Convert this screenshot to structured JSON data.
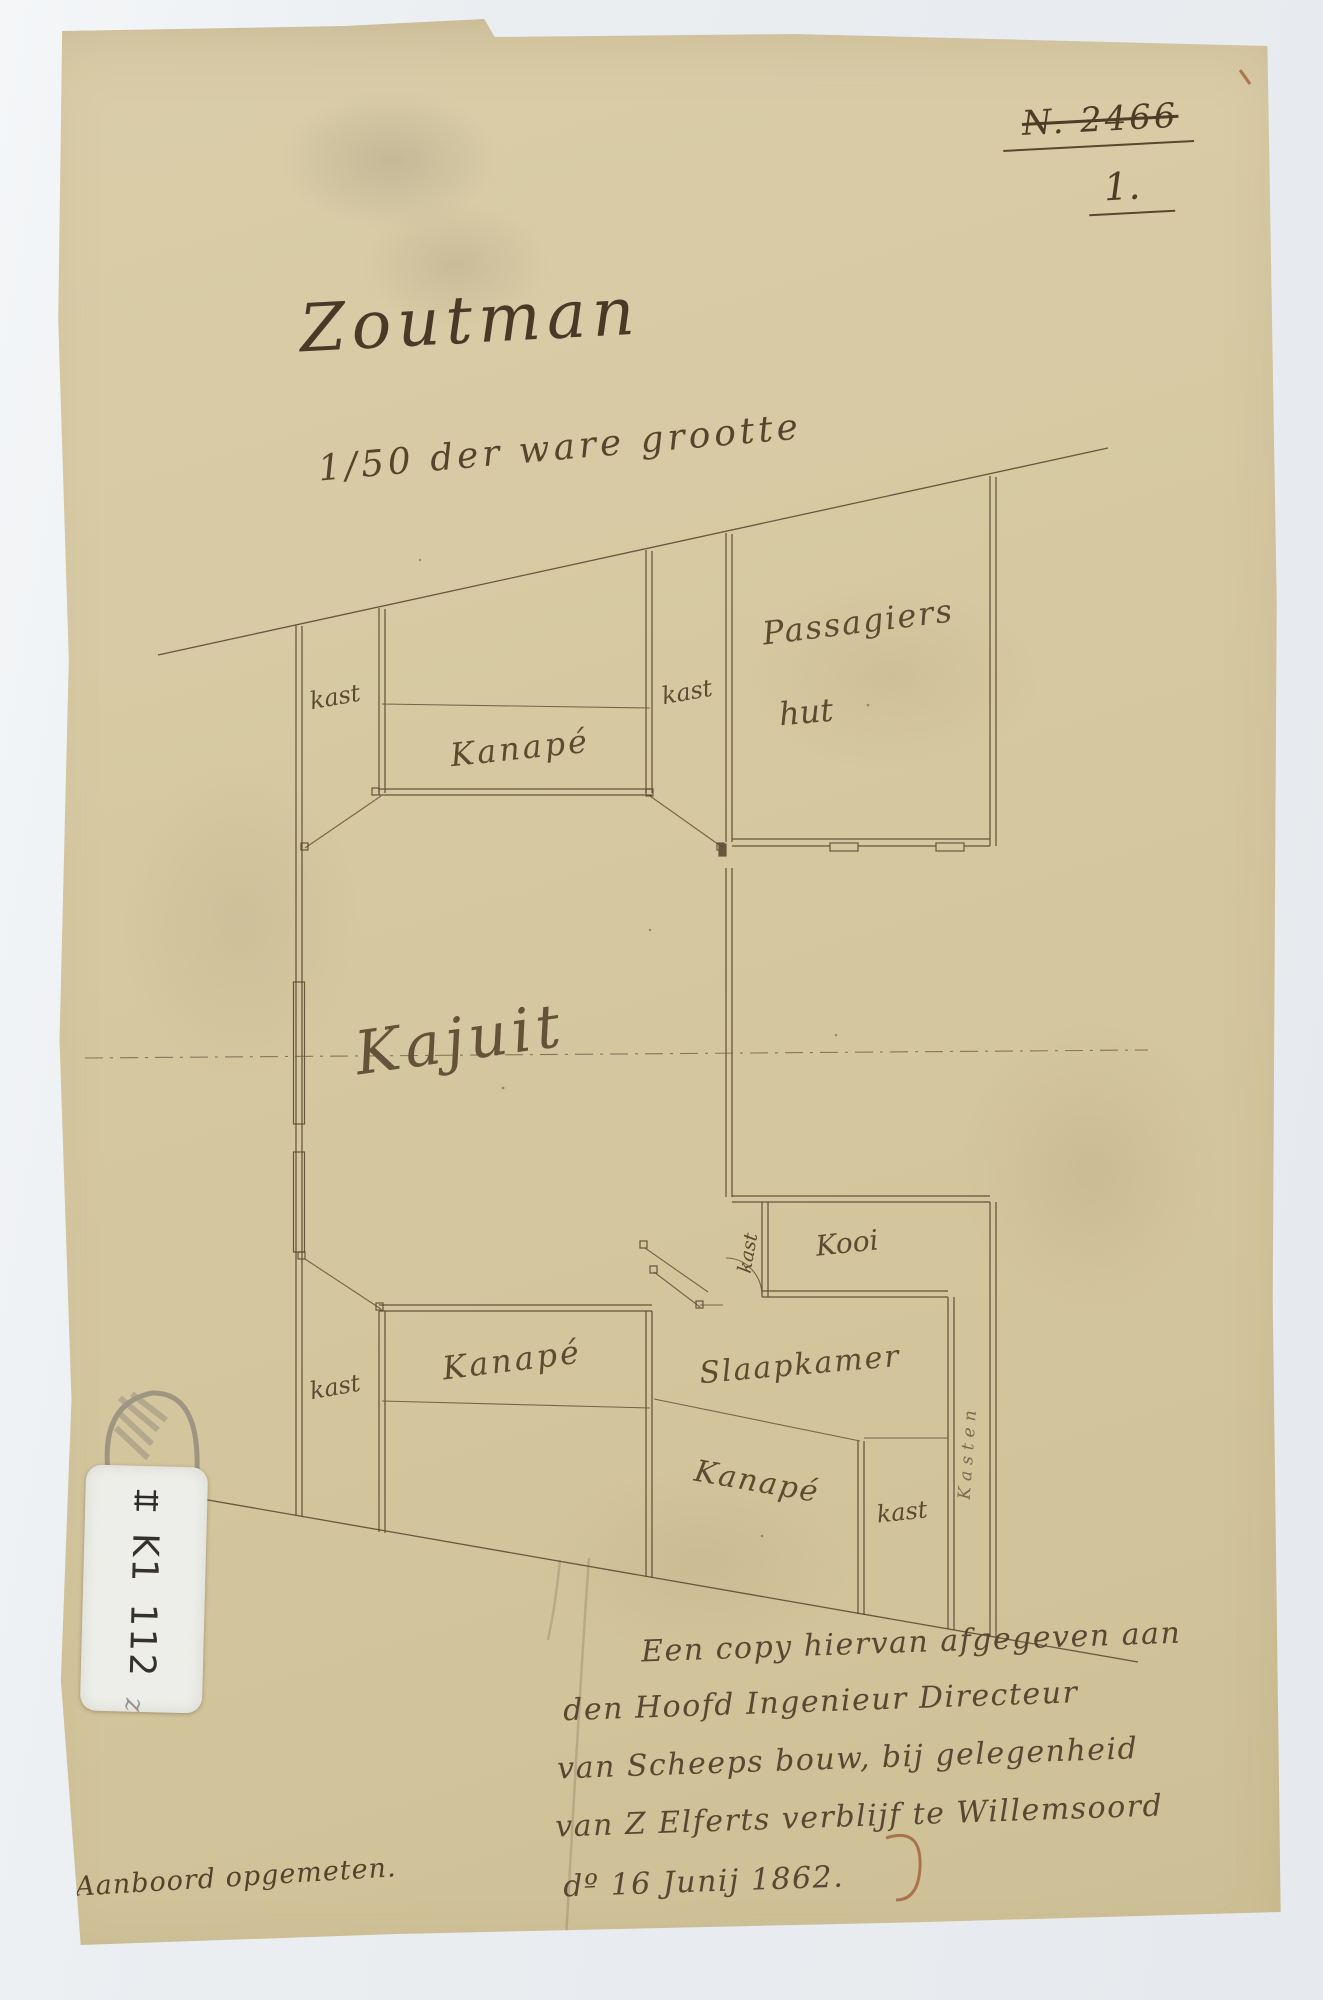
{
  "header": {
    "archive_no": "N. 2466",
    "archive_no_struck_through": true,
    "sheet_no": "1."
  },
  "title": "Zoutman",
  "scale_note": "1/50 der ware grootte",
  "rooms": {
    "kast_upper_left": "kast",
    "kanape_upper": "Kanapé",
    "kast_upper_right": "kast",
    "passagiers_hut_line1": "Passagiers",
    "passagiers_hut_line2": "hut",
    "kajuit": "Kajuit",
    "kast_bij_kooi": "kast",
    "kooi": "Kooi",
    "slaapkamer": "Slaapkamer",
    "kast_lower_left": "kast",
    "kanape_lower": "Kanapé",
    "kanape_bottom": "Kanapé",
    "kast_bottom": "kast",
    "kasten_wall": "Kasten"
  },
  "notes": {
    "measured": "Aanboord opgemeten.",
    "copy_line1": "Een copy hiervan afgegeven aan",
    "copy_line2": "den Hoofd Ingenieur Directeur",
    "copy_line3": "van Scheeps bouw, bij gelegenheid",
    "copy_line4": "van Z Elferts verblijf te Willemsoord",
    "copy_line5": "dº 16 Junij 1862."
  },
  "sticker": {
    "symbol_icon": "roman-numeral-II-ladder",
    "code": "K1",
    "number": "112",
    "pencil_mark": "z"
  },
  "colors": {
    "paper": "#d6c9a2",
    "ink": "#54422c",
    "pencil": "#8a8276",
    "background": "#eaeef1",
    "sticker": "#edeee9",
    "red_mark": "#9b512e"
  }
}
